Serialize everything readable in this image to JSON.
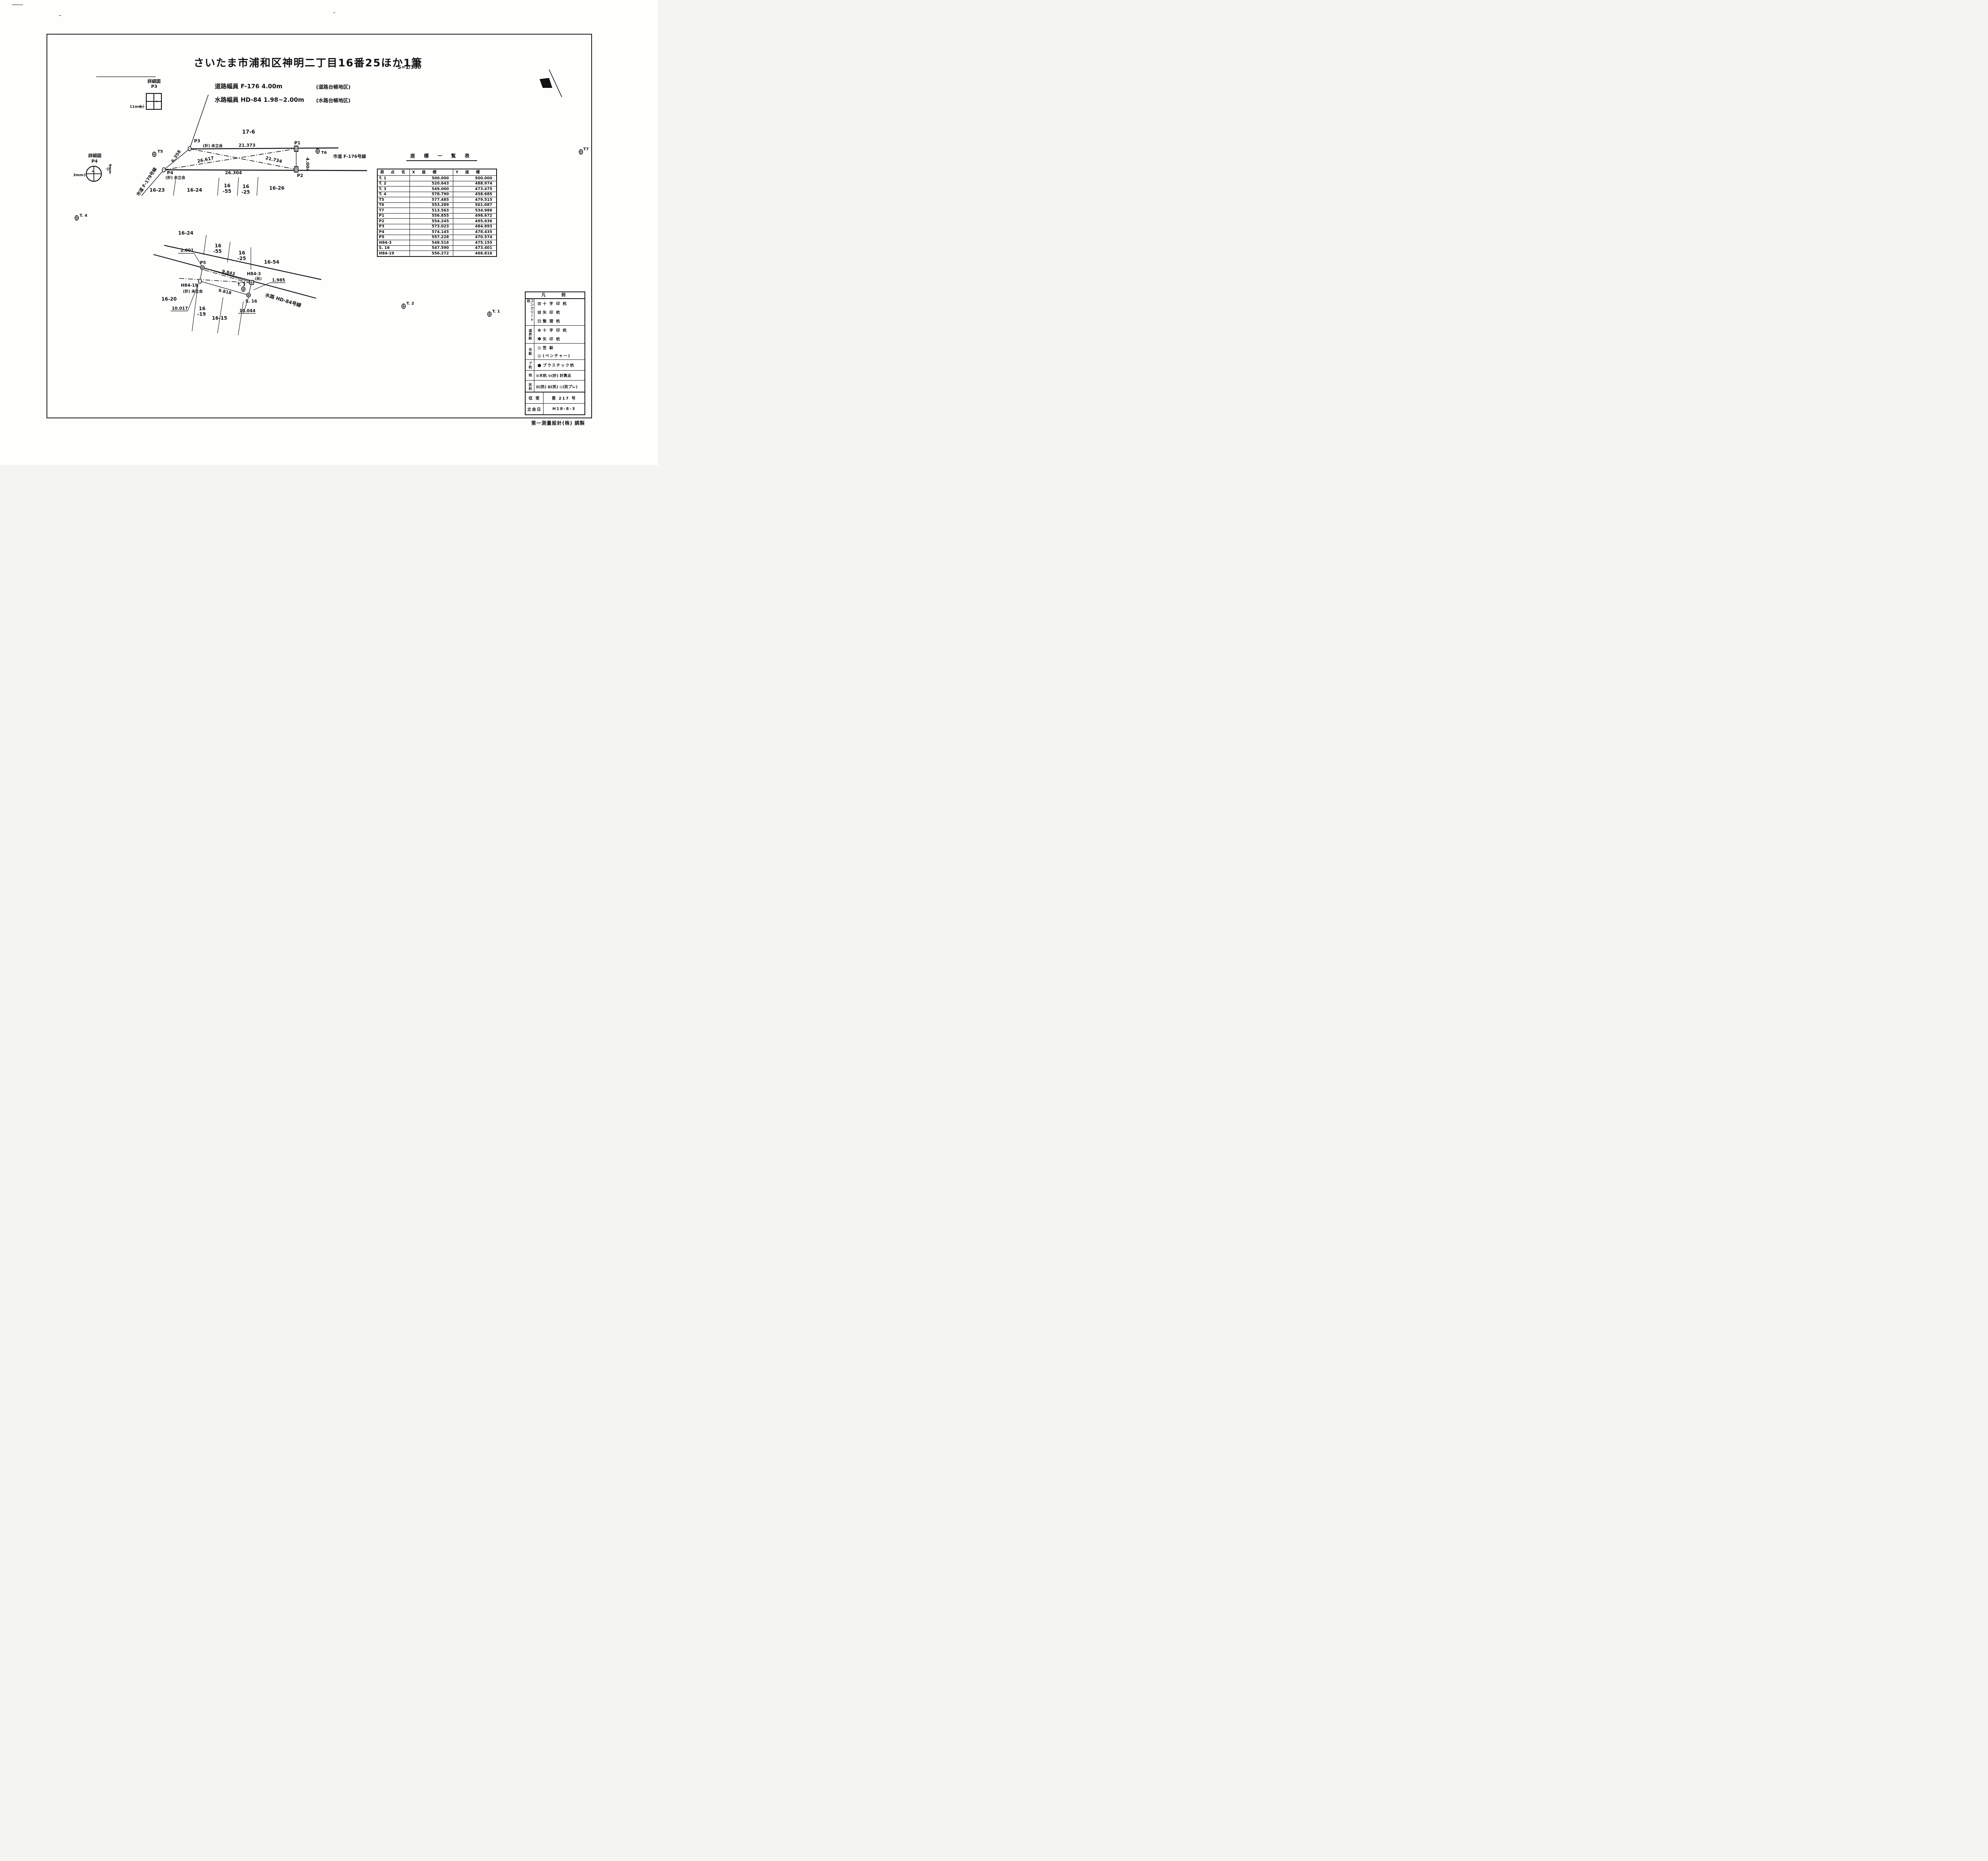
{
  "page": {
    "title": "さいたま市浦和区神明二丁目16番25ほか1筆",
    "scale": "S=1/300",
    "road_width_label": "道路幅員 F-176 4.00m",
    "road_width_note": "(道路台帳地区)",
    "water_width_label": "水路幅員 HD-84 1.98~2.00m",
    "water_width_note": "(水路台帳地区)",
    "footer": "第一測量設計(株) 調製"
  },
  "details": {
    "p3": {
      "title": "詳細図",
      "name": "P3",
      "dim": "11mm"
    },
    "p4": {
      "title": "詳細図",
      "name": "P4",
      "dim_v": "9mm",
      "dim_h": "3mm"
    }
  },
  "upper_diagram": {
    "parcel": "17-6",
    "road_right": "市道 F-176号線",
    "road_left": "市道 F-179号線",
    "p1": "P1",
    "p2": "P2",
    "p3": "P3",
    "p4": "P4",
    "p3_note": "(計) 未立会",
    "p4_note": "(計) 未立会",
    "t5": "T5",
    "t6": "T6",
    "m_top": "21.373",
    "m_bottom": "26.304",
    "m_diag1": "26.617",
    "m_diag2": "21.734",
    "m_left": "6.358",
    "m_right": "4.004",
    "k16_23": "16-23",
    "k16_24": "16-24",
    "k16a": "16",
    "k16_55": "-55",
    "k16b": "16",
    "k16_25": "-25",
    "k16_26": "16-26"
  },
  "lower_diagram": {
    "waterway": "水路 HD-84号線",
    "k16_24": "16-24",
    "k16a": "16",
    "k16_55": "-55",
    "k16b": "16",
    "k16_25": "-25",
    "k16_54": "16-54",
    "k16_20": "16-20",
    "k16c": "16",
    "k16_19": "-19",
    "k16_15": "16-15",
    "p5": "P5",
    "h84_3": "H84-3",
    "h84_3_note": "(民)",
    "h84_19": "H84-19",
    "h84_19_note": "(計) 未立会",
    "t3": "T. 3",
    "s16": "S. 16",
    "m_top": "9.843",
    "m_bottom": "9.818",
    "m_left": "2.001",
    "m_right": "1.985",
    "m_d1": "10.017",
    "m_d2": "10.044"
  },
  "ref_points": {
    "t4": "T. 4",
    "t2": "T. 2",
    "t1": "T. 1",
    "t7": "T7"
  },
  "coordinate_table": {
    "title": "座 標 一 覧 表",
    "headers": [
      "測 点 名",
      "X 座 標",
      "Y 座 標"
    ],
    "rows": [
      {
        "n": "T. 1",
        "x": "500.000",
        "y": "500.000"
      },
      {
        "n": "T. 2",
        "x": "520.643",
        "y": "488.974"
      },
      {
        "n": "T. 3",
        "x": "549.060",
        "y": "473.475"
      },
      {
        "n": "T. 4",
        "x": "578.790",
        "y": "458.685"
      },
      {
        "n": "T5",
        "x": "577.485",
        "y": "479.515"
      },
      {
        "n": "T6",
        "x": "553.289",
        "y": "501.087"
      },
      {
        "n": "T7",
        "x": "513.563",
        "y": "534.986"
      },
      {
        "n": "P1",
        "x": "556.855",
        "y": "498.672"
      },
      {
        "n": "P2",
        "x": "554.245",
        "y": "495.636"
      },
      {
        "n": "P3",
        "x": "573.023",
        "y": "484.693"
      },
      {
        "n": "P4",
        "x": "574.145",
        "y": "478.435"
      },
      {
        "n": "P5",
        "x": "557.228",
        "y": "470.574"
      },
      {
        "n": "H84-3",
        "x": "548.516",
        "y": "475.155"
      },
      {
        "n": "S. 16",
        "x": "547.590",
        "y": "473.401"
      },
      {
        "n": "H84-19",
        "x": "556.272",
        "y": "468.816"
      }
    ]
  },
  "legend": {
    "title": "凡 例",
    "groups": [
      {
        "label": "コンクリート杭",
        "rows": [
          {
            "sym": "⊞",
            "text": "十 字 印 杭"
          },
          {
            "sym": "⊠",
            "text": "矢 印 杭"
          },
          {
            "sym": "⊡",
            "text": "整 理 杭"
          }
        ]
      },
      {
        "label": "道界鋲",
        "rows": [
          {
            "sym": "⊕",
            "text": "十 字 印 杭"
          },
          {
            "sym": "Φ",
            "text": "矢 印 杭"
          }
        ]
      },
      {
        "label": "市鋲",
        "rows": [
          {
            "sym": "◎",
            "text": "笠 鋲"
          },
          {
            "sym": "◎",
            "text": "(ベンチャー)"
          }
        ]
      },
      {
        "label": "プ杭",
        "rows": [
          {
            "sym": "●",
            "text": "プラスチック杭"
          }
        ]
      },
      {
        "label": "他",
        "rows": [
          {
            "sym": "",
            "text": "⊙木杭 ⊙(計) 計算点"
          }
        ]
      },
      {
        "label": "民杭",
        "rows": [
          {
            "sym": "",
            "text": "⊞(民) ⊠(民) ◎(民プレ)"
          }
        ]
      }
    ]
  },
  "receipt": {
    "r1_label": "収 受",
    "r1_value": "第 217 号",
    "r2_label": "立会日",
    "r2_value": "H18-8-3"
  }
}
